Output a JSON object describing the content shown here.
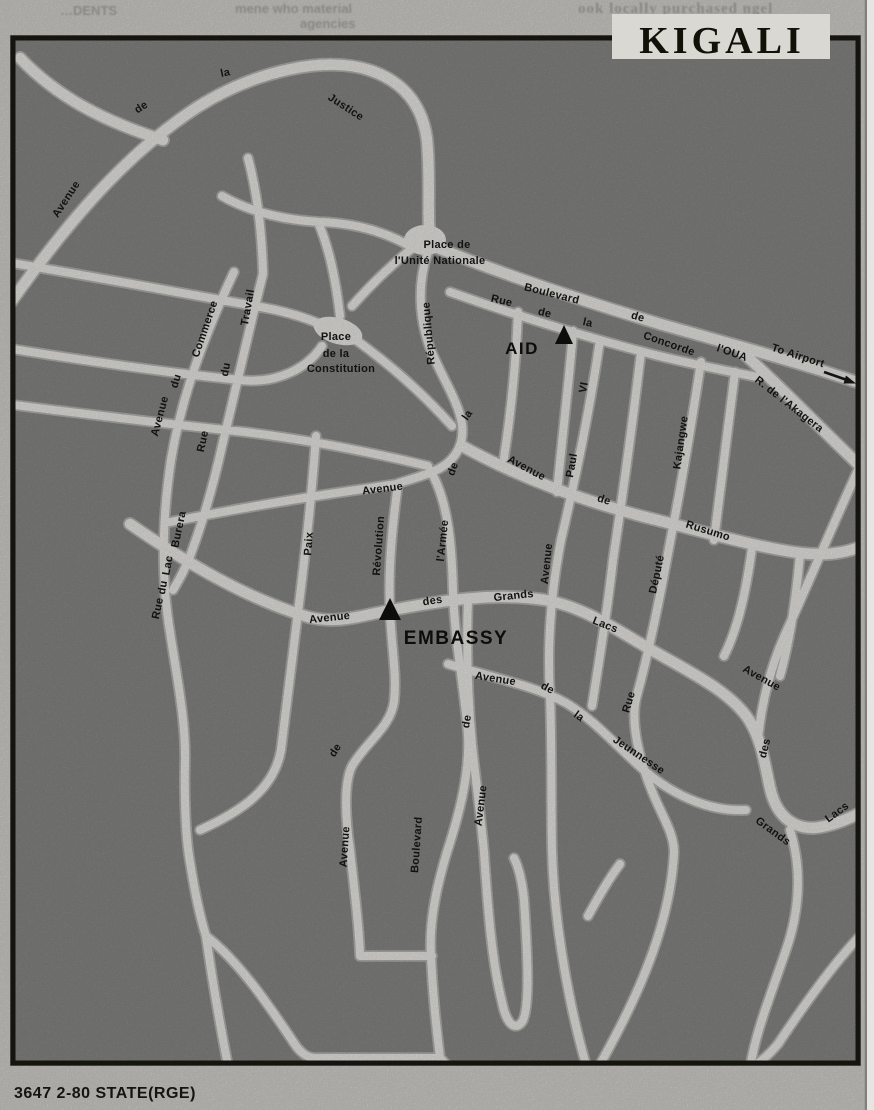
{
  "page": {
    "title": "KIGALI",
    "caption": "3647 2-80 STATE(RGE)",
    "bleed_fragments": {
      "left": "…DENTS",
      "middle": "mene who material",
      "middle2": "agencies",
      "right": "ook locally purchased ngel"
    }
  },
  "map": {
    "colors": {
      "paper": "#d9d8d3",
      "ground": "#8c8c8a",
      "road": "#f2f1ec",
      "ink": "#141412"
    },
    "markers": [
      {
        "id": "aid",
        "label": "AID"
      },
      {
        "id": "embassy",
        "label": "EMBASSY"
      }
    ],
    "street_labels": [
      {
        "t": "Avenue",
        "x": 69,
        "y": 201,
        "r": -57
      },
      {
        "t": "de",
        "x": 143,
        "y": 110,
        "r": -33
      },
      {
        "t": "la",
        "x": 226,
        "y": 76,
        "r": -12
      },
      {
        "t": "Justice",
        "x": 344,
        "y": 110,
        "r": 33
      },
      {
        "t": "Place de",
        "x": 447,
        "y": 248,
        "r": 0,
        "s": 12
      },
      {
        "t": "l'Unité Nationale",
        "x": 440,
        "y": 264,
        "r": 0,
        "s": 12
      },
      {
        "t": "Boulevard",
        "x": 551,
        "y": 297,
        "r": 14
      },
      {
        "t": "de",
        "x": 637,
        "y": 320,
        "r": 16
      },
      {
        "t": "Concorde",
        "x": 668,
        "y": 347,
        "r": 19
      },
      {
        "t": "l'OUA",
        "x": 731,
        "y": 356,
        "r": 19,
        "s": 14
      },
      {
        "t": "To Airport",
        "x": 797,
        "y": 359,
        "r": 18,
        "s": 14
      },
      {
        "t": "R. de l'Akagera",
        "x": 787,
        "y": 407,
        "r": 38
      },
      {
        "t": "Rue",
        "x": 501,
        "y": 304,
        "r": 13
      },
      {
        "t": "de",
        "x": 544,
        "y": 316,
        "r": 13
      },
      {
        "t": "la",
        "x": 587,
        "y": 326,
        "r": 13
      },
      {
        "t": "République",
        "x": 432,
        "y": 333,
        "r": -95
      },
      {
        "t": "la",
        "x": 470,
        "y": 417,
        "r": -55
      },
      {
        "t": "de",
        "x": 456,
        "y": 470,
        "r": -70
      },
      {
        "t": "Avenue",
        "x": 383,
        "y": 492,
        "r": -7
      },
      {
        "t": "Avenue",
        "x": 525,
        "y": 471,
        "r": 28
      },
      {
        "t": "de",
        "x": 603,
        "y": 503,
        "r": 17
      },
      {
        "t": "Rusumo",
        "x": 707,
        "y": 534,
        "r": 17
      },
      {
        "t": "VI",
        "x": 587,
        "y": 388,
        "r": -80
      },
      {
        "t": "Paul",
        "x": 575,
        "y": 466,
        "r": -80
      },
      {
        "t": "Avenue",
        "x": 550,
        "y": 564,
        "r": -84
      },
      {
        "t": "Kajangwe",
        "x": 684,
        "y": 443,
        "r": -82
      },
      {
        "t": "Député",
        "x": 660,
        "y": 575,
        "r": -78
      },
      {
        "t": "Rue",
        "x": 632,
        "y": 703,
        "r": -73
      },
      {
        "t": "Commerce",
        "x": 208,
        "y": 330,
        "r": -71
      },
      {
        "t": "du",
        "x": 179,
        "y": 382,
        "r": -73
      },
      {
        "t": "Avenue",
        "x": 163,
        "y": 417,
        "r": -75
      },
      {
        "t": "Travail",
        "x": 251,
        "y": 308,
        "r": -80
      },
      {
        "t": "du",
        "x": 229,
        "y": 370,
        "r": -80
      },
      {
        "t": "Rue",
        "x": 206,
        "y": 442,
        "r": -78
      },
      {
        "t": "Place",
        "x": 336,
        "y": 340,
        "r": 0,
        "s": 12
      },
      {
        "t": "de la",
        "x": 336,
        "y": 357,
        "r": 0,
        "s": 12
      },
      {
        "t": "Constitution",
        "x": 341,
        "y": 372,
        "r": 0,
        "s": 12
      },
      {
        "t": "Burera",
        "x": 182,
        "y": 530,
        "r": -78
      },
      {
        "t": "Lac",
        "x": 171,
        "y": 566,
        "r": -80
      },
      {
        "t": "du",
        "x": 166,
        "y": 588,
        "r": -80
      },
      {
        "t": "Rue",
        "x": 161,
        "y": 609,
        "r": -78
      },
      {
        "t": "Paix",
        "x": 312,
        "y": 544,
        "r": -86
      },
      {
        "t": "Révolution",
        "x": 382,
        "y": 546,
        "r": -86
      },
      {
        "t": "l'Armée",
        "x": 446,
        "y": 541,
        "r": -84
      },
      {
        "t": "Avenue",
        "x": 330,
        "y": 621,
        "r": -6
      },
      {
        "t": "des",
        "x": 433,
        "y": 604,
        "r": -8
      },
      {
        "t": "Grands",
        "x": 514,
        "y": 599,
        "r": -6
      },
      {
        "t": "Lacs",
        "x": 604,
        "y": 628,
        "r": 22
      },
      {
        "t": "Avenue",
        "x": 495,
        "y": 682,
        "r": 9
      },
      {
        "t": "de",
        "x": 546,
        "y": 691,
        "r": 28
      },
      {
        "t": "la",
        "x": 577,
        "y": 719,
        "r": 36
      },
      {
        "t": "Jeunnesse",
        "x": 637,
        "y": 758,
        "r": 34
      },
      {
        "t": "de",
        "x": 470,
        "y": 722,
        "r": -80
      },
      {
        "t": "Avenue",
        "x": 484,
        "y": 806,
        "r": -83
      },
      {
        "t": "de",
        "x": 338,
        "y": 752,
        "r": -58
      },
      {
        "t": "Avenue",
        "x": 348,
        "y": 847,
        "r": -86
      },
      {
        "t": "Boulevard",
        "x": 420,
        "y": 845,
        "r": -86
      },
      {
        "t": "Avenue",
        "x": 760,
        "y": 681,
        "r": 29
      },
      {
        "t": "des",
        "x": 768,
        "y": 749,
        "r": -76
      },
      {
        "t": "Grands",
        "x": 771,
        "y": 834,
        "r": 36
      },
      {
        "t": "Lacs",
        "x": 839,
        "y": 815,
        "r": -36
      }
    ]
  }
}
